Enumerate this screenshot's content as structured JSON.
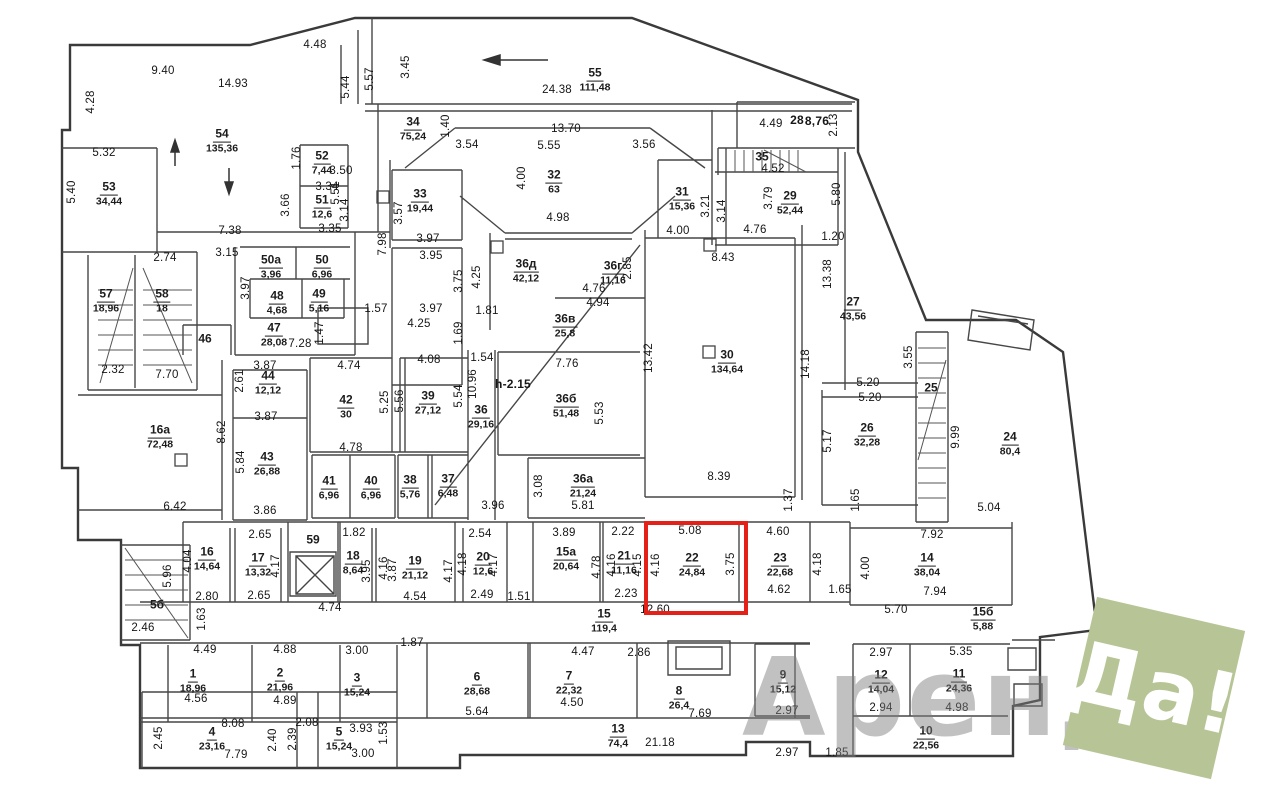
{
  "watermark": {
    "word": "Аренда",
    "badge": "Да!",
    "badge_color": "#b7c596",
    "word_color": "#7d7d7d"
  },
  "highlight": {
    "room": "22",
    "color": "#e32119",
    "x": 644,
    "y": 521,
    "w": 96,
    "h": 86
  },
  "rooms": [
    {
      "n": "53",
      "a": "34,44",
      "x": 109,
      "y": 193
    },
    {
      "n": "54",
      "a": "135,36",
      "x": 222,
      "y": 140
    },
    {
      "n": "52",
      "a": "7,44",
      "x": 322,
      "y": 162
    },
    {
      "n": "51",
      "a": "12,6",
      "x": 322,
      "y": 206
    },
    {
      "n": "55",
      "a": "111,48",
      "x": 595,
      "y": 79
    },
    {
      "n": "34",
      "a": "75,24",
      "x": 413,
      "y": 128
    },
    {
      "n": "33",
      "a": "19,44",
      "x": 420,
      "y": 200
    },
    {
      "n": "32",
      "a": "63",
      "x": 554,
      "y": 181
    },
    {
      "n": "31",
      "a": "15,36",
      "x": 682,
      "y": 198
    },
    {
      "n": "35",
      "a": "",
      "x": 762,
      "y": 157
    },
    {
      "n": "29",
      "a": "52,44",
      "x": 790,
      "y": 202
    },
    {
      "n": "27",
      "a": "43,56",
      "x": 853,
      "y": 308
    },
    {
      "n": "30",
      "a": "134,64",
      "x": 727,
      "y": 361
    },
    {
      "n": "26",
      "a": "32,28",
      "x": 867,
      "y": 434
    },
    {
      "n": "25",
      "a": "",
      "x": 931,
      "y": 388
    },
    {
      "n": "24",
      "a": "80,4",
      "x": 1010,
      "y": 443
    },
    {
      "n": "57",
      "a": "18,96",
      "x": 106,
      "y": 300
    },
    {
      "n": "58",
      "a": "18",
      "x": 162,
      "y": 300
    },
    {
      "n": "50а",
      "a": "3,96",
      "x": 271,
      "y": 266
    },
    {
      "n": "50",
      "a": "6,96",
      "x": 322,
      "y": 266
    },
    {
      "n": "48",
      "a": "4,68",
      "x": 277,
      "y": 302
    },
    {
      "n": "49",
      "a": "5,16",
      "x": 319,
      "y": 300
    },
    {
      "n": "47",
      "a": "28,08",
      "x": 274,
      "y": 334
    },
    {
      "n": "46",
      "a": "",
      "x": 205,
      "y": 339
    },
    {
      "n": "44",
      "a": "12,12",
      "x": 268,
      "y": 382
    },
    {
      "n": "43",
      "a": "26,88",
      "x": 267,
      "y": 463
    },
    {
      "n": "42",
      "a": "30",
      "x": 346,
      "y": 406
    },
    {
      "n": "39",
      "a": "27,12",
      "x": 428,
      "y": 402
    },
    {
      "n": "41",
      "a": "6,96",
      "x": 329,
      "y": 487
    },
    {
      "n": "40",
      "a": "6,96",
      "x": 371,
      "y": 487
    },
    {
      "n": "38",
      "a": "5,76",
      "x": 410,
      "y": 486
    },
    {
      "n": "37",
      "a": "6,48",
      "x": 448,
      "y": 485
    },
    {
      "n": "36",
      "a": "29,16",
      "x": 481,
      "y": 416
    },
    {
      "n": "36д",
      "a": "42,12",
      "x": 526,
      "y": 270
    },
    {
      "n": "36г",
      "a": "11,16",
      "x": 613,
      "y": 272
    },
    {
      "n": "36в",
      "a": "25,8",
      "x": 565,
      "y": 325
    },
    {
      "n": "36б",
      "a": "51,48",
      "x": 566,
      "y": 405
    },
    {
      "n": "36а",
      "a": "21,24",
      "x": 583,
      "y": 485
    },
    {
      "n": "16а",
      "a": "72,48",
      "x": 160,
      "y": 436
    },
    {
      "n": "16",
      "a": "14,64",
      "x": 207,
      "y": 558
    },
    {
      "n": "17",
      "a": "13,32",
      "x": 258,
      "y": 564
    },
    {
      "n": "59",
      "a": "",
      "x": 313,
      "y": 540
    },
    {
      "n": "18",
      "a": "8,64",
      "x": 353,
      "y": 562
    },
    {
      "n": "19",
      "a": "21,12",
      "x": 415,
      "y": 567
    },
    {
      "n": "20",
      "a": "12,6",
      "x": 483,
      "y": 563
    },
    {
      "n": "15а",
      "a": "20,64",
      "x": 566,
      "y": 558
    },
    {
      "n": "21",
      "a": "11,16",
      "x": 624,
      "y": 562
    },
    {
      "n": "22",
      "a": "24,84",
      "x": 692,
      "y": 564
    },
    {
      "n": "23",
      "a": "22,68",
      "x": 780,
      "y": 564
    },
    {
      "n": "14",
      "a": "38,04",
      "x": 927,
      "y": 564
    },
    {
      "n": "15б",
      "a": "5,88",
      "x": 983,
      "y": 618
    },
    {
      "n": "15",
      "a": "119,4",
      "x": 604,
      "y": 620
    },
    {
      "n": "13",
      "a": "74,4",
      "x": 618,
      "y": 735
    },
    {
      "n": "5б",
      "a": "",
      "x": 157,
      "y": 605
    },
    {
      "n": "1",
      "a": "18,96",
      "x": 193,
      "y": 680
    },
    {
      "n": "2",
      "a": "21,96",
      "x": 280,
      "y": 679
    },
    {
      "n": "3",
      "a": "15,24",
      "x": 357,
      "y": 684
    },
    {
      "n": "4",
      "a": "23,16",
      "x": 212,
      "y": 738
    },
    {
      "n": "5",
      "a": "15,24",
      "x": 339,
      "y": 738
    },
    {
      "n": "6",
      "a": "28,68",
      "x": 477,
      "y": 683
    },
    {
      "n": "7",
      "a": "22,32",
      "x": 569,
      "y": 682
    },
    {
      "n": "8",
      "a": "26,4",
      "x": 679,
      "y": 697
    },
    {
      "n": "9",
      "a": "15,12",
      "x": 783,
      "y": 681
    },
    {
      "n": "12",
      "a": "14,04",
      "x": 881,
      "y": 681
    },
    {
      "n": "11",
      "a": "24,36",
      "x": 959,
      "y": 680
    },
    {
      "n": "10",
      "a": "22,56",
      "x": 926,
      "y": 737
    }
  ],
  "dims": [
    {
      "t": "9.40",
      "x": 163,
      "y": 71
    },
    {
      "t": "14.93",
      "x": 233,
      "y": 84
    },
    {
      "t": "4.48",
      "x": 315,
      "y": 45
    },
    {
      "t": "4.28",
      "x": 91,
      "y": 102,
      "r": 1
    },
    {
      "t": "5.32",
      "x": 104,
      "y": 153
    },
    {
      "t": "5.40",
      "x": 72,
      "y": 192,
      "r": 1
    },
    {
      "t": "5.51",
      "x": 336,
      "y": 193,
      "r": 1
    },
    {
      "t": "5.44",
      "x": 346,
      "y": 87,
      "r": 1
    },
    {
      "t": "5.57",
      "x": 370,
      "y": 79,
      "r": 1
    },
    {
      "t": "3.45",
      "x": 406,
      "y": 67,
      "r": 1
    },
    {
      "t": "24.38",
      "x": 557,
      "y": 90
    },
    {
      "t": "13.70",
      "x": 566,
      "y": 129
    },
    {
      "t": "3.54",
      "x": 467,
      "y": 145
    },
    {
      "t": "5.55",
      "x": 549,
      "y": 146
    },
    {
      "t": "3.56",
      "x": 644,
      "y": 145
    },
    {
      "t": "1.40",
      "x": 446,
      "y": 126,
      "r": 1
    },
    {
      "t": "4.00",
      "x": 522,
      "y": 178,
      "r": 1
    },
    {
      "t": "4.98",
      "x": 558,
      "y": 218
    },
    {
      "t": "3.57",
      "x": 399,
      "y": 213,
      "r": 1
    },
    {
      "t": "28",
      "x": 797,
      "y": 120,
      "b": 1
    },
    {
      "t": "8,76",
      "x": 817,
      "y": 121,
      "b": 1
    },
    {
      "t": "4.49",
      "x": 771,
      "y": 124
    },
    {
      "t": "2.13",
      "x": 834,
      "y": 125,
      "r": 1
    },
    {
      "t": "4.52",
      "x": 773,
      "y": 169
    },
    {
      "t": "3.79",
      "x": 769,
      "y": 198,
      "r": 1
    },
    {
      "t": "3.21",
      "x": 706,
      "y": 206,
      "r": 1
    },
    {
      "t": "3.14",
      "x": 722,
      "y": 211,
      "r": 1
    },
    {
      "t": "5.80",
      "x": 837,
      "y": 194,
      "r": 1
    },
    {
      "t": "1.20",
      "x": 833,
      "y": 237
    },
    {
      "t": "13.38",
      "x": 828,
      "y": 274,
      "r": 1
    },
    {
      "t": "1.76",
      "x": 297,
      "y": 158,
      "r": 1
    },
    {
      "t": "3.50",
      "x": 341,
      "y": 171
    },
    {
      "t": "3.34",
      "x": 327,
      "y": 187
    },
    {
      "t": "3.14",
      "x": 345,
      "y": 210,
      "r": 1
    },
    {
      "t": "3.35",
      "x": 330,
      "y": 229
    },
    {
      "t": "3.66",
      "x": 286,
      "y": 205,
      "r": 1
    },
    {
      "t": "7.38",
      "x": 230,
      "y": 231
    },
    {
      "t": "3.15",
      "x": 227,
      "y": 253
    },
    {
      "t": "2.74",
      "x": 165,
      "y": 258
    },
    {
      "t": "3.97",
      "x": 246,
      "y": 288,
      "r": 1
    },
    {
      "t": "2.32",
      "x": 113,
      "y": 370
    },
    {
      "t": "7.70",
      "x": 167,
      "y": 375
    },
    {
      "t": "7.28",
      "x": 300,
      "y": 344
    },
    {
      "t": "1.47",
      "x": 320,
      "y": 333,
      "r": 1
    },
    {
      "t": "1.57",
      "x": 376,
      "y": 309
    },
    {
      "t": "7.98",
      "x": 383,
      "y": 244,
      "r": 1
    },
    {
      "t": "3.97",
      "x": 428,
      "y": 239
    },
    {
      "t": "3.95",
      "x": 431,
      "y": 256
    },
    {
      "t": "3.97",
      "x": 431,
      "y": 309
    },
    {
      "t": "3.75",
      "x": 459,
      "y": 281,
      "r": 1
    },
    {
      "t": "4.25",
      "x": 477,
      "y": 277,
      "r": 1
    },
    {
      "t": "4.25",
      "x": 419,
      "y": 324
    },
    {
      "t": "1.81",
      "x": 487,
      "y": 311
    },
    {
      "t": "1.69",
      "x": 459,
      "y": 333,
      "r": 1
    },
    {
      "t": "1.54",
      "x": 482,
      "y": 358
    },
    {
      "t": "4.08",
      "x": 429,
      "y": 360
    },
    {
      "t": "10.96",
      "x": 473,
      "y": 384,
      "r": 1
    },
    {
      "t": "5.54",
      "x": 459,
      "y": 396,
      "r": 1
    },
    {
      "t": "5.56",
      "x": 400,
      "y": 401,
      "r": 1
    },
    {
      "t": "5.25",
      "x": 385,
      "y": 402,
      "r": 1
    },
    {
      "t": "4.74",
      "x": 349,
      "y": 366
    },
    {
      "t": "3.87",
      "x": 265,
      "y": 366
    },
    {
      "t": "2.61",
      "x": 240,
      "y": 381,
      "r": 1
    },
    {
      "t": "3.87",
      "x": 266,
      "y": 417
    },
    {
      "t": "5.84",
      "x": 241,
      "y": 462,
      "r": 1
    },
    {
      "t": "3.86",
      "x": 265,
      "y": 511
    },
    {
      "t": "8.62",
      "x": 222,
      "y": 432,
      "r": 1
    },
    {
      "t": "6.42",
      "x": 175,
      "y": 507
    },
    {
      "t": "4.78",
      "x": 351,
      "y": 448
    },
    {
      "t": "3.96",
      "x": 493,
      "y": 506
    },
    {
      "t": "3.08",
      "x": 539,
      "y": 486,
      "r": 1
    },
    {
      "t": "5.81",
      "x": 583,
      "y": 506
    },
    {
      "t": "h-2.15",
      "x": 513,
      "y": 384,
      "b": 1
    },
    {
      "t": "7.76",
      "x": 567,
      "y": 364
    },
    {
      "t": "5.53",
      "x": 600,
      "y": 413,
      "r": 1
    },
    {
      "t": "4.76",
      "x": 594,
      "y": 289
    },
    {
      "t": "4.94",
      "x": 598,
      "y": 303
    },
    {
      "t": "2.85",
      "x": 628,
      "y": 268,
      "r": 1
    },
    {
      "t": "4.00",
      "x": 678,
      "y": 231
    },
    {
      "t": "4.76",
      "x": 755,
      "y": 230
    },
    {
      "t": "8.43",
      "x": 723,
      "y": 258
    },
    {
      "t": "8.39",
      "x": 719,
      "y": 477
    },
    {
      "t": "13.42",
      "x": 649,
      "y": 358,
      "r": 1
    },
    {
      "t": "14.18",
      "x": 806,
      "y": 364,
      "r": 1
    },
    {
      "t": "1.37",
      "x": 789,
      "y": 500,
      "r": 1
    },
    {
      "t": "5.20",
      "x": 868,
      "y": 383
    },
    {
      "t": "5.20",
      "x": 870,
      "y": 398
    },
    {
      "t": "5.17",
      "x": 828,
      "y": 441,
      "r": 1
    },
    {
      "t": "1.65",
      "x": 856,
      "y": 500,
      "r": 1
    },
    {
      "t": "3.55",
      "x": 909,
      "y": 357,
      "r": 1
    },
    {
      "t": "9.99",
      "x": 956,
      "y": 437,
      "r": 1
    },
    {
      "t": "5.04",
      "x": 989,
      "y": 508
    },
    {
      "t": "7.92",
      "x": 932,
      "y": 535
    },
    {
      "t": "4.00",
      "x": 866,
      "y": 568,
      "r": 1
    },
    {
      "t": "7.94",
      "x": 935,
      "y": 592
    },
    {
      "t": "5.70",
      "x": 896,
      "y": 610
    },
    {
      "t": "1.65",
      "x": 840,
      "y": 590
    },
    {
      "t": "2.65",
      "x": 260,
      "y": 535
    },
    {
      "t": "2.65",
      "x": 259,
      "y": 596
    },
    {
      "t": "2.80",
      "x": 207,
      "y": 597
    },
    {
      "t": "4.04",
      "x": 188,
      "y": 561,
      "r": 1
    },
    {
      "t": "4.17",
      "x": 276,
      "y": 566,
      "r": 1
    },
    {
      "t": "1.82",
      "x": 354,
      "y": 533
    },
    {
      "t": "3.95",
      "x": 367,
      "y": 571,
      "r": 1
    },
    {
      "t": "4.16",
      "x": 384,
      "y": 568,
      "r": 1
    },
    {
      "t": "3.87",
      "x": 393,
      "y": 570,
      "r": 1
    },
    {
      "t": "4.54",
      "x": 415,
      "y": 597
    },
    {
      "t": "2.54",
      "x": 480,
      "y": 534
    },
    {
      "t": "4.18",
      "x": 463,
      "y": 564,
      "r": 1
    },
    {
      "t": "4.17",
      "x": 494,
      "y": 565,
      "r": 1
    },
    {
      "t": "4.17",
      "x": 449,
      "y": 571,
      "r": 1
    },
    {
      "t": "2.49",
      "x": 482,
      "y": 595
    },
    {
      "t": "1.51",
      "x": 519,
      "y": 597
    },
    {
      "t": "3.89",
      "x": 564,
      "y": 533
    },
    {
      "t": "4.78",
      "x": 597,
      "y": 567,
      "r": 1
    },
    {
      "t": "2.22",
      "x": 623,
      "y": 532
    },
    {
      "t": "4.16",
      "x": 612,
      "y": 565,
      "r": 1
    },
    {
      "t": "4.15",
      "x": 638,
      "y": 565,
      "r": 1
    },
    {
      "t": "2.23",
      "x": 626,
      "y": 594
    },
    {
      "t": "5.08",
      "x": 690,
      "y": 531
    },
    {
      "t": "4.16",
      "x": 656,
      "y": 565,
      "r": 1
    },
    {
      "t": "3.75",
      "x": 731,
      "y": 564,
      "r": 1
    },
    {
      "t": "12.60",
      "x": 655,
      "y": 610
    },
    {
      "t": "4.60",
      "x": 778,
      "y": 532
    },
    {
      "t": "4.62",
      "x": 779,
      "y": 590
    },
    {
      "t": "4.18",
      "x": 818,
      "y": 564,
      "r": 1
    },
    {
      "t": "5.96",
      "x": 168,
      "y": 576,
      "r": 1
    },
    {
      "t": "1.63",
      "x": 202,
      "y": 619,
      "r": 1
    },
    {
      "t": "2.46",
      "x": 143,
      "y": 628
    },
    {
      "t": "4.74",
      "x": 330,
      "y": 608
    },
    {
      "t": "4.49",
      "x": 205,
      "y": 650
    },
    {
      "t": "4.88",
      "x": 285,
      "y": 650
    },
    {
      "t": "3.00",
      "x": 357,
      "y": 651
    },
    {
      "t": "1.87",
      "x": 412,
      "y": 643
    },
    {
      "t": "4.56",
      "x": 196,
      "y": 699
    },
    {
      "t": "4.89",
      "x": 285,
      "y": 701
    },
    {
      "t": "8.08",
      "x": 233,
      "y": 724
    },
    {
      "t": "7.79",
      "x": 236,
      "y": 755
    },
    {
      "t": "2.45",
      "x": 159,
      "y": 738,
      "r": 1
    },
    {
      "t": "2.40",
      "x": 273,
      "y": 740,
      "r": 1
    },
    {
      "t": "2.39",
      "x": 293,
      "y": 739,
      "r": 1
    },
    {
      "t": "2.08",
      "x": 307,
      "y": 723
    },
    {
      "t": "3.93",
      "x": 361,
      "y": 729
    },
    {
      "t": "3.00",
      "x": 363,
      "y": 754
    },
    {
      "t": "1.53",
      "x": 384,
      "y": 733,
      "r": 1
    },
    {
      "t": "5.64",
      "x": 477,
      "y": 712
    },
    {
      "t": "4.47",
      "x": 583,
      "y": 652
    },
    {
      "t": "4.50",
      "x": 572,
      "y": 703
    },
    {
      "t": "2.86",
      "x": 639,
      "y": 653
    },
    {
      "t": "7.69",
      "x": 700,
      "y": 714
    },
    {
      "t": "21.18",
      "x": 660,
      "y": 743
    },
    {
      "t": "2.97",
      "x": 787,
      "y": 711
    },
    {
      "t": "2.97",
      "x": 881,
      "y": 653
    },
    {
      "t": "2.94",
      "x": 881,
      "y": 708
    },
    {
      "t": "5.35",
      "x": 961,
      "y": 652
    },
    {
      "t": "4.98",
      "x": 957,
      "y": 708
    },
    {
      "t": "2.97",
      "x": 787,
      "y": 753
    },
    {
      "t": "1.85",
      "x": 837,
      "y": 753
    }
  ]
}
